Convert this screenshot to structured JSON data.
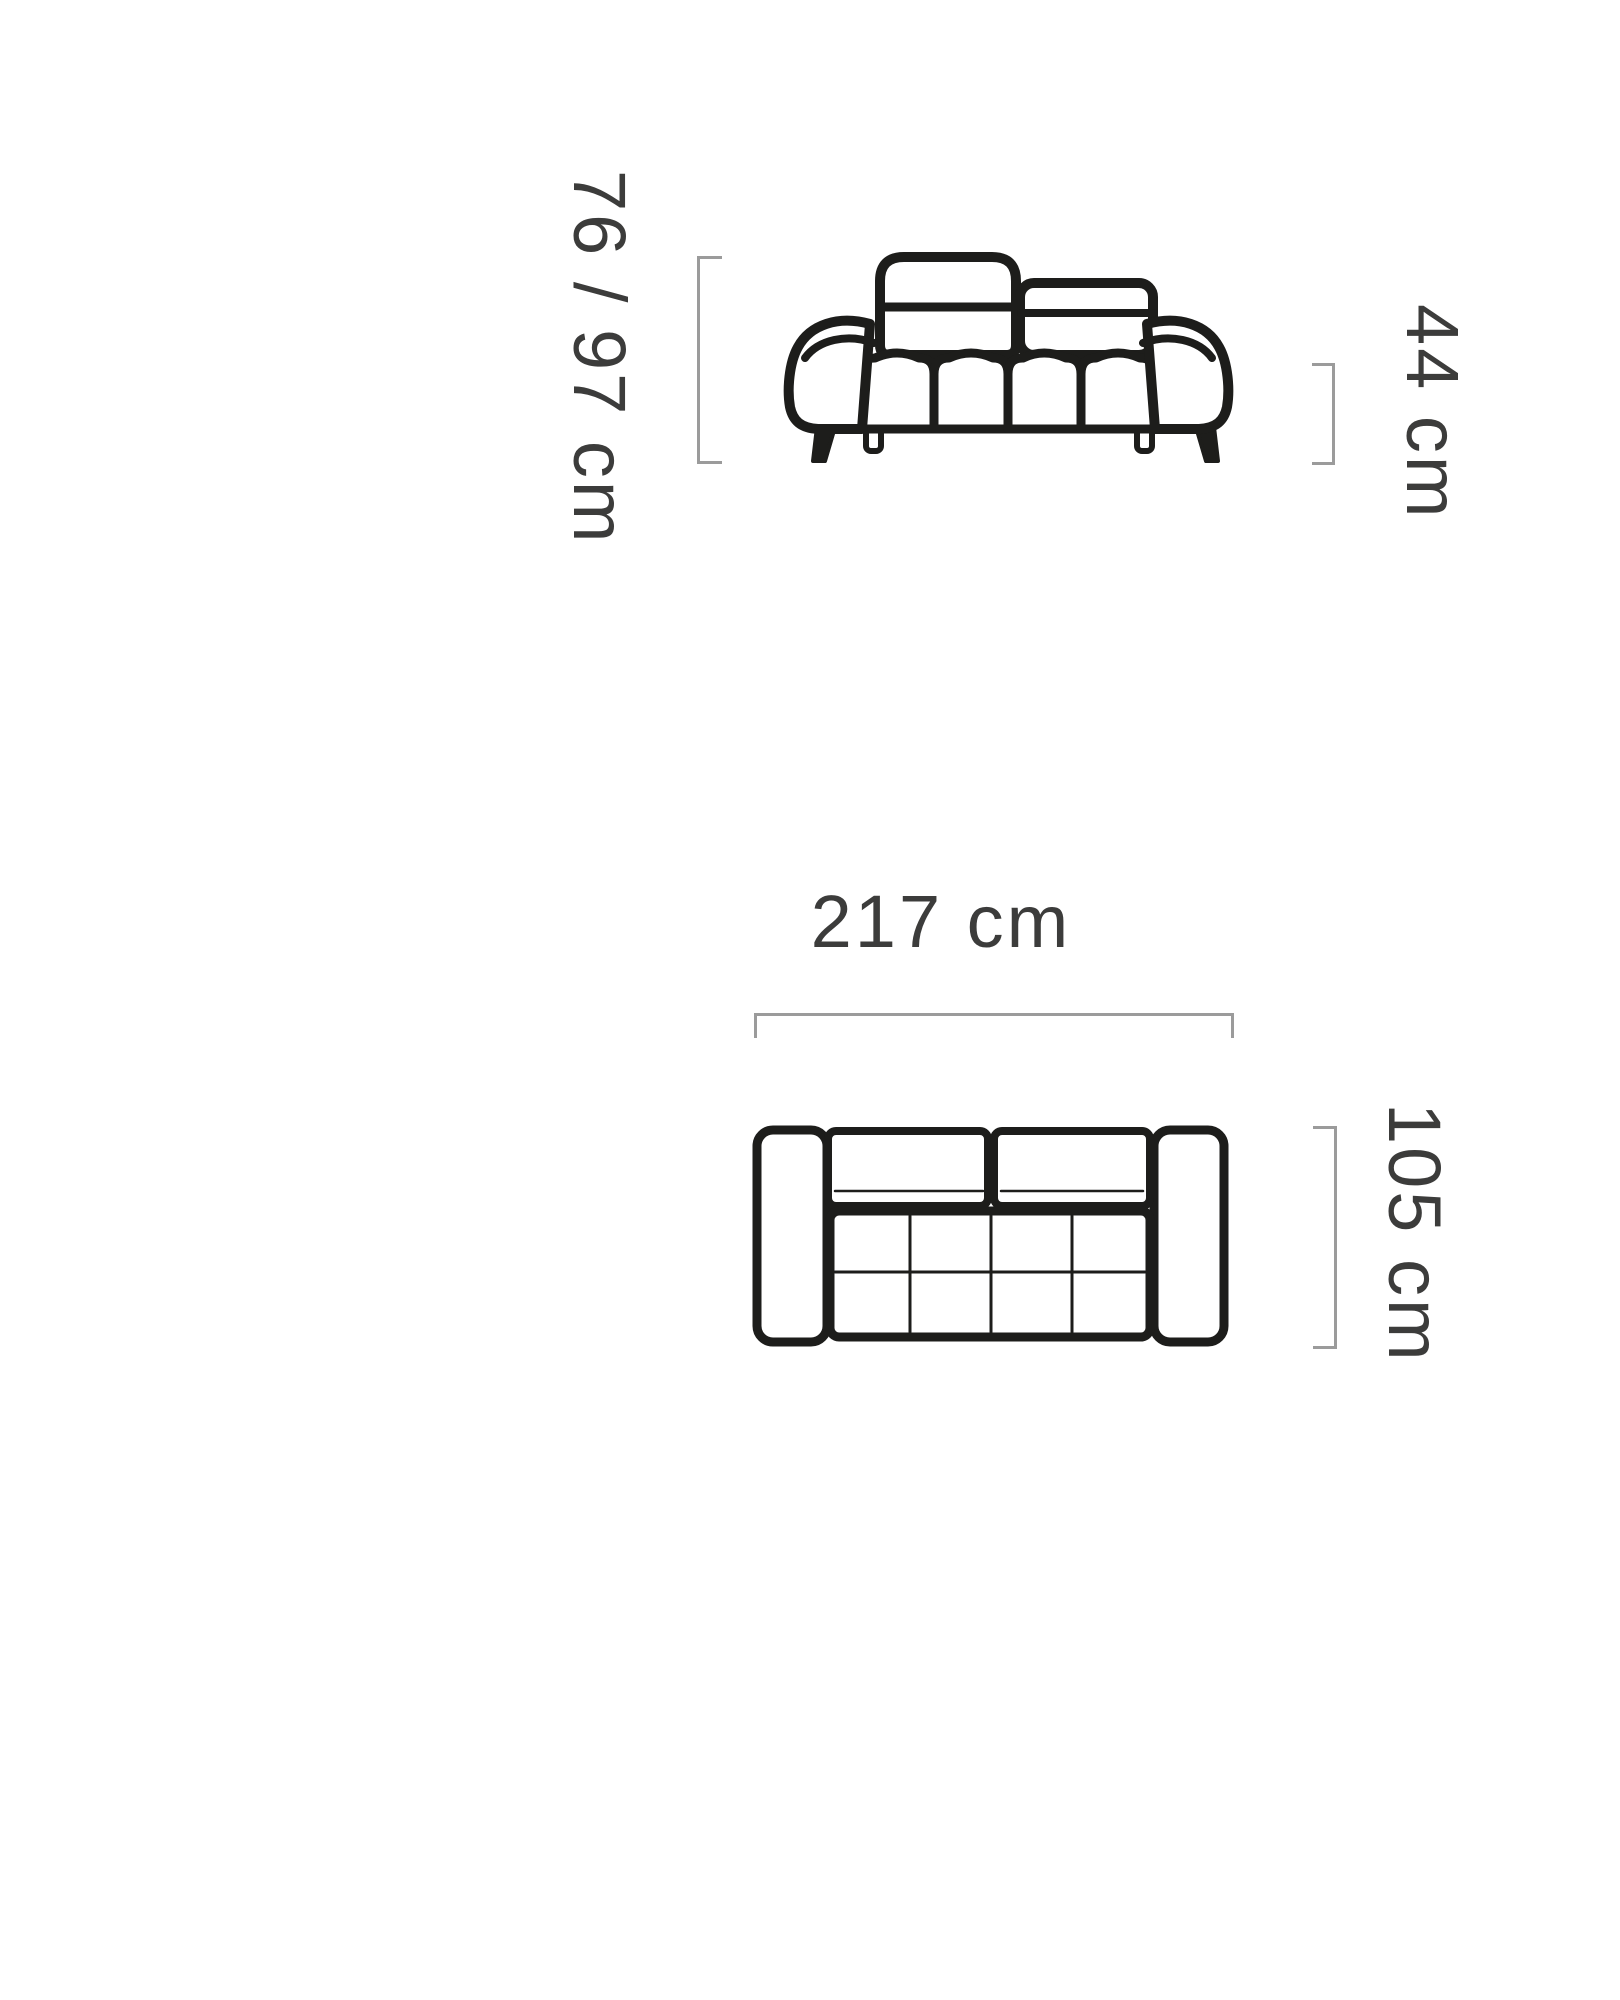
{
  "diagram": {
    "title": "sofa dimension diagram",
    "front_view": {
      "name": "sofa front elevation",
      "height_label": "76 / 97 cm",
      "seat_height_label": "44 cm"
    },
    "top_view": {
      "name": "sofa top plan",
      "width_label": "217 cm",
      "depth_label": "105 cm"
    },
    "colors": {
      "background": "#ffffff",
      "outline": "#1d1d1b",
      "dimension_line": "#9b9b9b",
      "label_text": "#3c3c3b"
    }
  }
}
